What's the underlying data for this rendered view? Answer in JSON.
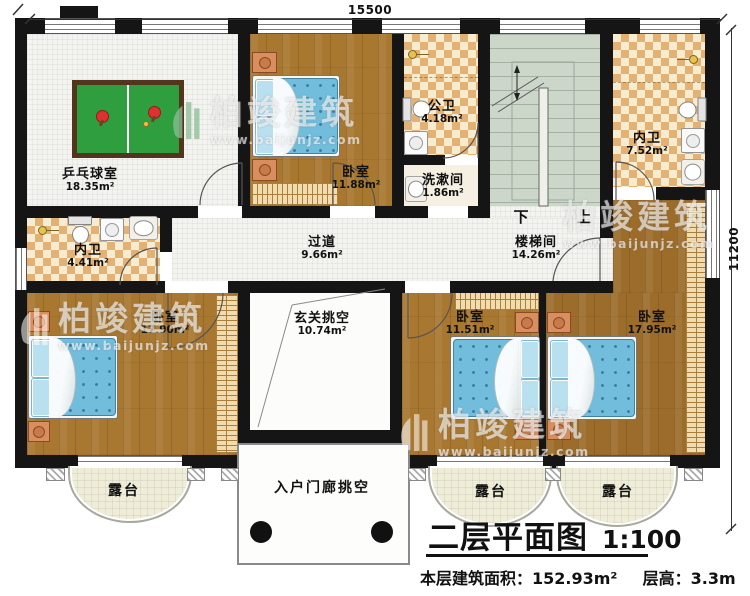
{
  "dimensions": {
    "top": "15500",
    "right": "11200"
  },
  "rooms": {
    "pingpong": {
      "name": "乒乓球室",
      "area": "18.35m²"
    },
    "bedroom_top": {
      "name": "卧室",
      "area": "11.88m²"
    },
    "public_bath": {
      "name": "公卫",
      "area": "4.18m²"
    },
    "washroom": {
      "name": "洗漱间",
      "area": "1.86m²"
    },
    "stairwell": {
      "name": "楼梯间",
      "area": "14.26m²"
    },
    "ensuite_right": {
      "name": "内卫",
      "area": "7.52m²"
    },
    "ensuite_left": {
      "name": "内卫",
      "area": "4.41m²"
    },
    "corridor": {
      "name": "过道",
      "area": "9.66m²"
    },
    "bedroom_left": {
      "name": "卧室",
      "area": "17.90m²"
    },
    "entry_void": {
      "name": "玄关挑空",
      "area": "10.74m²"
    },
    "bedroom_mid": {
      "name": "卧室",
      "area": "11.51m²"
    },
    "bedroom_right": {
      "name": "卧室",
      "area": "17.95m²"
    },
    "terrace_left": {
      "name": "露台"
    },
    "terrace_mid": {
      "name": "露台"
    },
    "terrace_right": {
      "name": "露台"
    },
    "porch": {
      "name": "入户门廊挑空"
    }
  },
  "stairs": {
    "down": "下",
    "up": "上"
  },
  "title": {
    "main": "二层平面图",
    "scale": "1:100",
    "area_label": "本层建筑面积：",
    "area_value": "152.93m²",
    "height_label": "层高：",
    "height_value": "3.3m"
  },
  "watermark": {
    "brand": "柏竣建筑",
    "url": "www.baijunjz.com"
  },
  "colors": {
    "wall": "#151515",
    "wood_floor": "#a87730",
    "bath_tile": "#e2b173",
    "stair": "#ccd7c9",
    "terrace": "#efecd8",
    "pingpong_table": "#2f9e3e",
    "bed": "#72bddc",
    "paddle_red": "#e03131"
  }
}
